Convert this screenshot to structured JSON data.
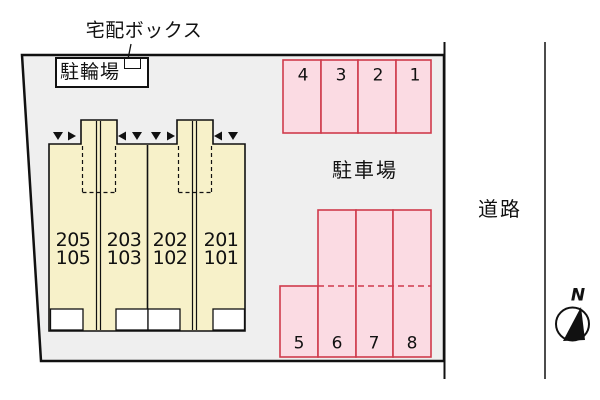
{
  "scene": {
    "delivery_box_label": "宅配ボックス",
    "bicycle_parking_label": "駐輪場",
    "parking_lot_label": "駐車場",
    "road_label": "道路",
    "north_label": "N"
  },
  "building": {
    "units": [
      {
        "upper": "205",
        "lower": "105"
      },
      {
        "upper": "203",
        "lower": "103"
      },
      {
        "upper": "202",
        "lower": "102"
      },
      {
        "upper": "201",
        "lower": "101"
      }
    ]
  },
  "parking": {
    "top_spaces": [
      "4",
      "3",
      "2",
      "1"
    ],
    "bottom_spaces": [
      "5",
      "6",
      "7",
      "8"
    ]
  },
  "colors": {
    "lot_fill": "#efefef",
    "building_fill": "#f7f1c9",
    "parking_fill": "#fbdbe3",
    "parking_border": "#cf3b4c",
    "line": "#111111"
  }
}
